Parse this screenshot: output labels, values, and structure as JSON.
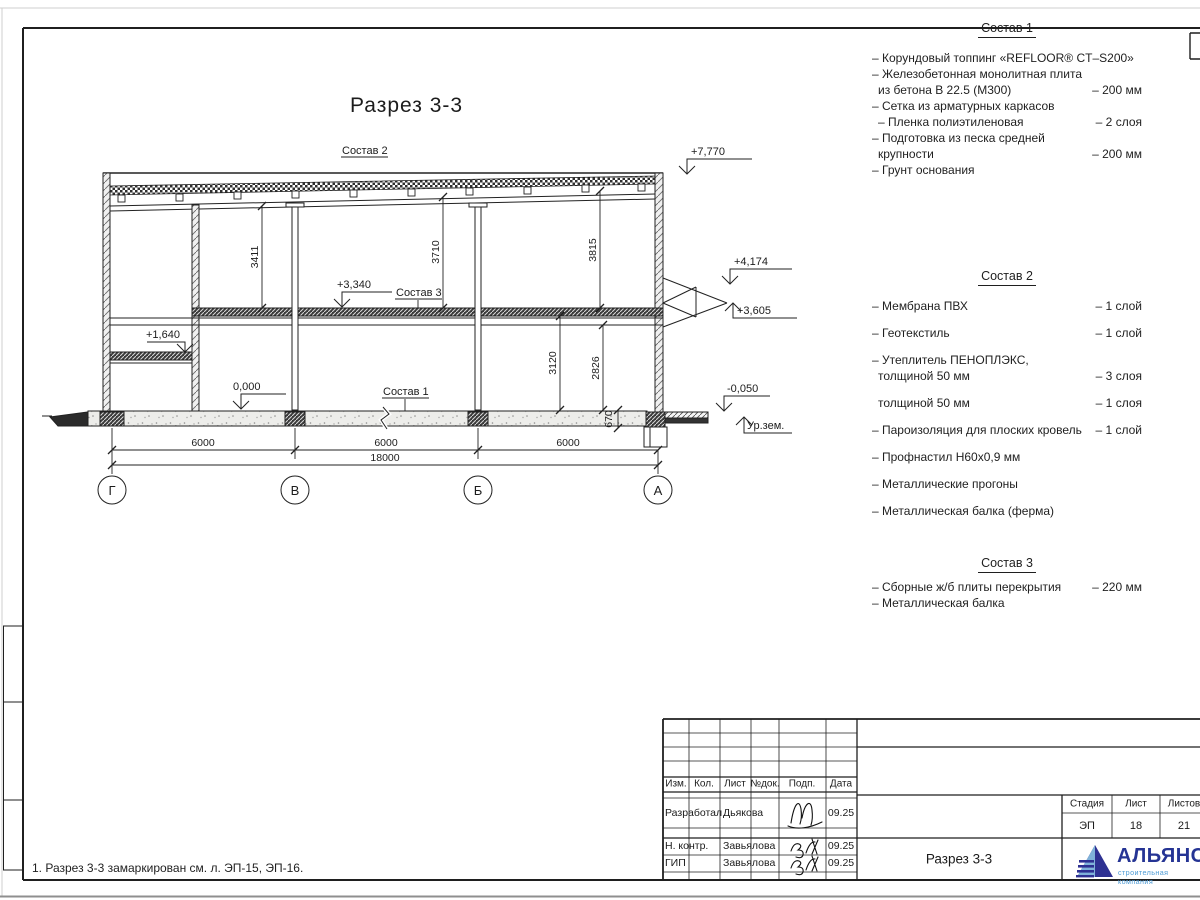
{
  "drawing": {
    "title": "Разрез 3-3",
    "labels": {
      "comp1_ref": "Состав 1",
      "comp2_ref": "Состав 2",
      "comp3_ref": "Состав 3"
    },
    "elevations": {
      "roof": "+7,770",
      "canopy_top": "+4,174",
      "canopy_bottom": "+3,605",
      "slab": "+3,340",
      "landing": "+1,640",
      "floor": "0,000",
      "apron": "-0,050",
      "ground": "Ур.зем."
    },
    "dims": {
      "v1": "3411",
      "v2": "3710",
      "v3": "3815",
      "v4": "3120",
      "v5": "2826",
      "v6": "670",
      "span1": "6000",
      "span2": "6000",
      "span3": "6000",
      "total": "18000"
    },
    "axes": {
      "a1": "Г",
      "a2": "В",
      "a3": "Б",
      "a4": "А"
    }
  },
  "comp1": {
    "title": "Состав 1",
    "items": [
      {
        "l1": "– Корундовый топпинг «REFLOOR® CT–S200»",
        "v": ""
      },
      {
        "l1": "– Железобетонная  монолитная плита",
        "l2": "из бетона В 22.5 (М300)",
        "v": "– 200 мм"
      },
      {
        "l1": "– Сетка из арматурных каркасов",
        "v": ""
      },
      {
        "l1": "– Пленка полиэтиленовая",
        "v": "– 2 слоя"
      },
      {
        "l1": "– Подготовка из песка средней",
        "l2": "крупности",
        "v": "– 200 мм"
      },
      {
        "l1": "– Грунт основания",
        "v": ""
      }
    ]
  },
  "comp2": {
    "title": "Состав 2",
    "items": [
      {
        "l1": "– Мембрана ПВХ",
        "v": "– 1 слой"
      },
      {
        "l1": "– Геотекстиль",
        "v": "– 1 слой"
      },
      {
        "l1": "– Утеплитель ПЕНОПЛЭКС,",
        "l2": "толщиной 50 мм",
        "v": "– 3 слоя"
      },
      {
        "l1": "– Утеплитель Эковер Y=100 кг/м3,",
        "l2": "толщиной 50 мм",
        "v": "– 1 слоя"
      },
      {
        "l1": "– Пароизоляция для плоских кровель",
        "v": "– 1 слой"
      },
      {
        "l1": "– Профнастил Н60х0,9 мм",
        "v": ""
      },
      {
        "l1": "– Металлические прогоны",
        "v": ""
      },
      {
        "l1": "– Металлическая балка (ферма)",
        "v": ""
      }
    ]
  },
  "comp3": {
    "title": "Состав 3",
    "items": [
      {
        "l1": "– Сборные ж/б плиты перекрытия",
        "v": "– 220 мм"
      },
      {
        "l1": "– Металлическая балка",
        "v": ""
      }
    ]
  },
  "note": "1. Разрез 3-3 замаркирован см. л. ЭП-15, ЭП-16.",
  "title_block": {
    "headers": {
      "izm": "Изм.",
      "kol": "Кол.",
      "list": "Лист",
      "ndok": "№док.",
      "podp": "Подп.",
      "data": "Дата"
    },
    "rows": [
      {
        "role": "Разработал",
        "name": "Дьякова",
        "date": "09.25"
      },
      {
        "role": "Н. контр.",
        "name": "Завьялова",
        "date": "09.25"
      },
      {
        "role": "ГИП",
        "name": "Завьялова",
        "date": "09.25"
      }
    ],
    "doc_title": "Разрез 3-3",
    "stage": {
      "h1": "Стадия",
      "h2": "Лист",
      "h3": "Листов",
      "v1": "ЭП",
      "v2": "18",
      "v3": "21"
    },
    "logo": {
      "name": "АЛЬЯНС",
      "subtitle": "строительная компания",
      "color_primary": "#2e3192",
      "color_accent": "#7fb2d9"
    }
  }
}
